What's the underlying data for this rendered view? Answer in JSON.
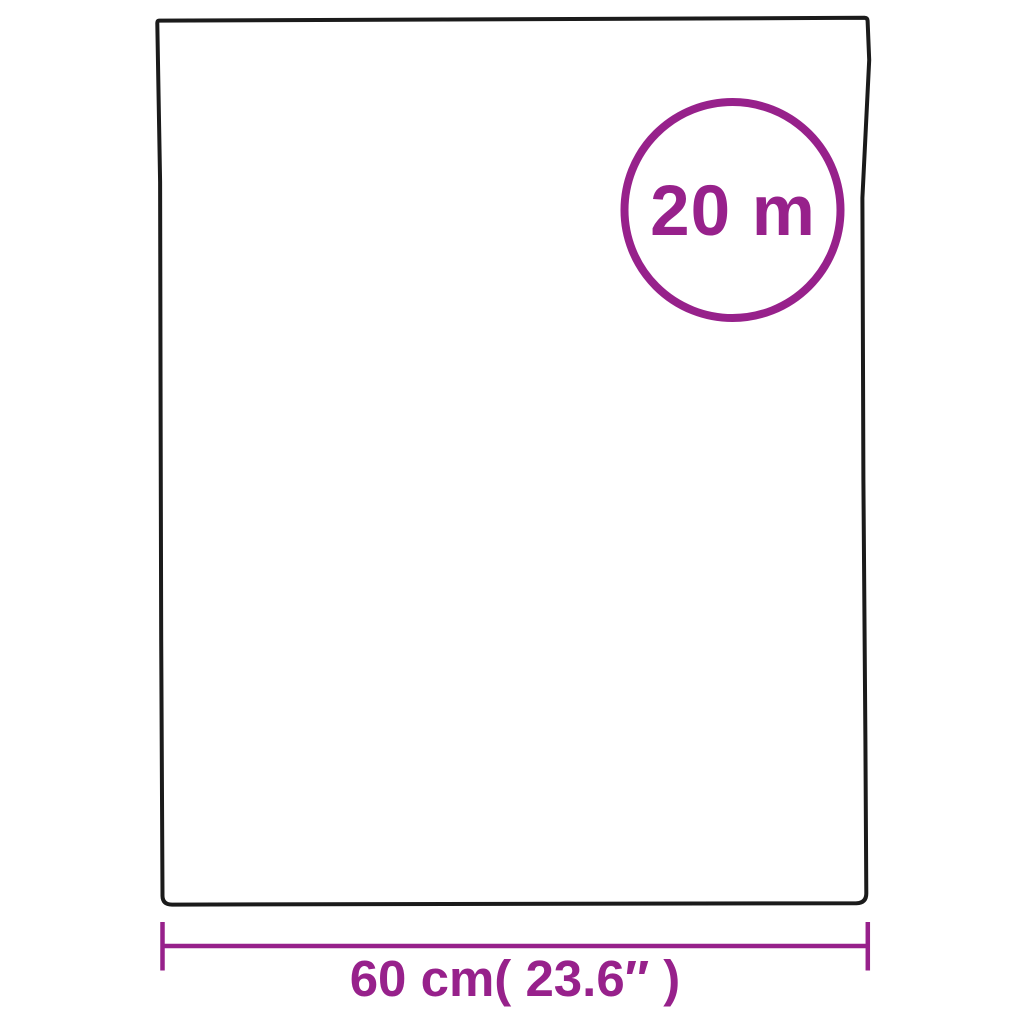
{
  "diagram": {
    "roll_length_badge": {
      "label": "20 m"
    },
    "width_dimension": {
      "label": "60 cm( 23.6″ )"
    },
    "colors": {
      "accent": "#97218b",
      "outline": "#1b1b1b",
      "background": "#ffffff"
    }
  }
}
